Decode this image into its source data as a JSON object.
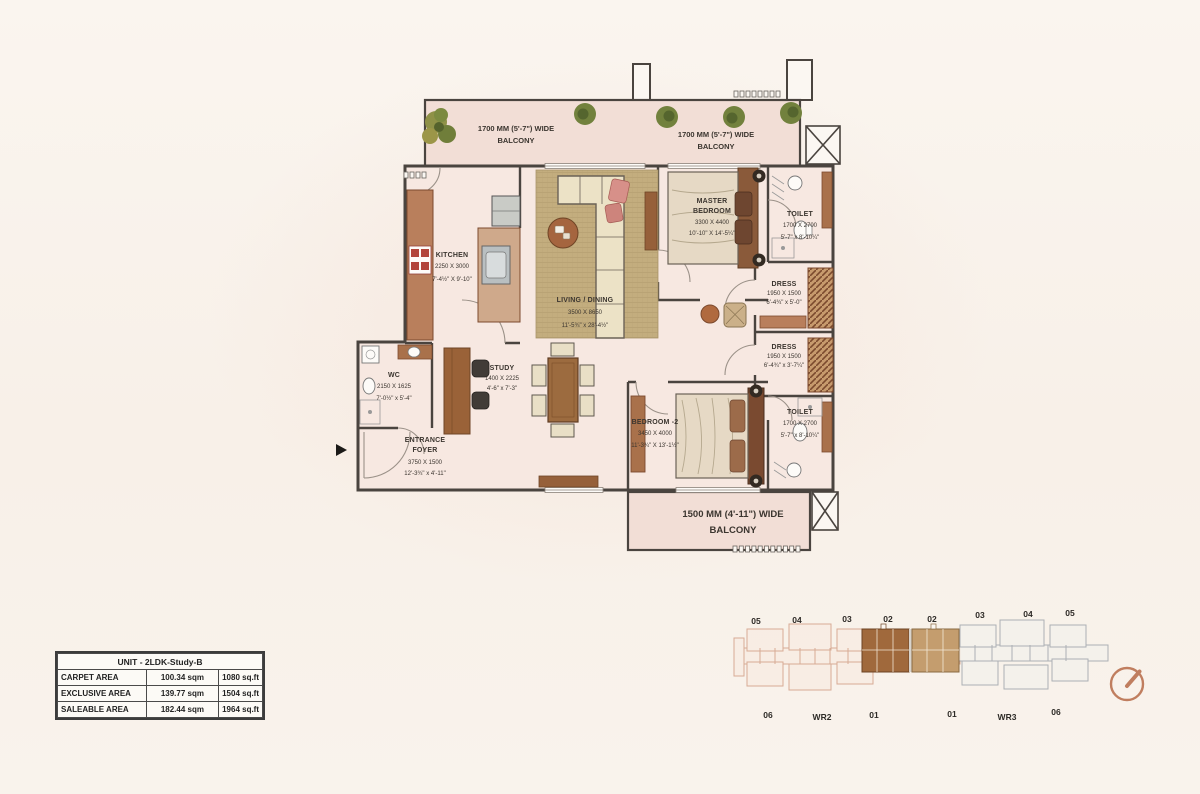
{
  "area_table": {
    "title": "UNIT - 2LDK-Study-B",
    "rows": [
      {
        "label": "CARPET AREA",
        "sqm": "100.34 sqm",
        "sqft": "1080 sq.ft"
      },
      {
        "label": "EXCLUSIVE AREA",
        "sqm": "139.77 sqm",
        "sqft": "1504 sq.ft"
      },
      {
        "label": "SALEABLE AREA",
        "sqm": "182.44 sqm",
        "sqft": "1964 sq.ft"
      }
    ]
  },
  "plan": {
    "balcony_top_left": {
      "line1": "1700 MM (5'-7\") WIDE",
      "line2": "BALCONY"
    },
    "balcony_top_right": {
      "line1": "1700 MM (5'-7\") WIDE",
      "line2": "BALCONY"
    },
    "balcony_bottom": {
      "line1": "1500 MM (4'-11\") WIDE",
      "line2": "BALCONY"
    },
    "rooms": {
      "kitchen": {
        "name": "KITCHEN",
        "mm": "2250 X 3000",
        "ft": "7'-4½\" X 9'-10\""
      },
      "living": {
        "name": "LIVING / DINING",
        "mm": "3500 X 8650",
        "ft": "11'-5¾\" x 28'-4½\""
      },
      "master": {
        "n1": "MASTER",
        "n2": "BEDROOM",
        "mm": "3300 X 4400",
        "ft": "10'-10\" X 14'-5¼\""
      },
      "toilet1": {
        "name": "TOILET",
        "mm": "1700 X 2700",
        "ft": "5'-7\" x 8'-10¼\""
      },
      "dress1": {
        "name": "DRESS",
        "mm": "1950 X 1500",
        "ft": "6'-4¾\" x 5'-0\""
      },
      "dress2": {
        "name": "DRESS",
        "mm": "1950 X 1500",
        "ft": "6'-4¾\" x 3'-7¼\""
      },
      "toilet2": {
        "name": "TOILET",
        "mm": "1700 X 2700",
        "ft": "5'-7\" x 8'-10¼\""
      },
      "bedroom2": {
        "name": "BEDROOM -2",
        "mm": "3450 X 4000",
        "ft": "11'-3¾\" X 13'-1½\""
      },
      "wc": {
        "name": "WC",
        "mm": "2150 X 1625",
        "ft": "7'-0½\" x 5'-4\""
      },
      "study": {
        "name": "STUDY",
        "mm": "1400 X 2225",
        "ft": "4'-6\" x 7'-3\""
      },
      "foyer": {
        "n1": "ENTRANCE",
        "n2": "FOYER",
        "mm": "3750 X 1500",
        "ft": "12'-3¾\" x 4'-11\""
      }
    }
  },
  "key_plan": {
    "top_labels": [
      "05",
      "04",
      "03",
      "02",
      "02",
      "03",
      "04",
      "05"
    ],
    "bottom_labels": [
      "06",
      "WR2",
      "01",
      "01",
      "WR3",
      "06"
    ]
  },
  "colors": {
    "wall": "#4a443f",
    "unit_fill": "#f7e8e1",
    "balcony_fill": "#f2ded6",
    "wood": "#a9714b",
    "wood_dark": "#8a5a3a",
    "rug": "#c3ad7e",
    "sofa": "#ece2c6",
    "highlight_primary": "#a0693c",
    "highlight_secondary": "#c49d6e",
    "wing_left": "#cf9a80",
    "wing_right": "#99a0a7",
    "compass": "#c07e5f"
  }
}
